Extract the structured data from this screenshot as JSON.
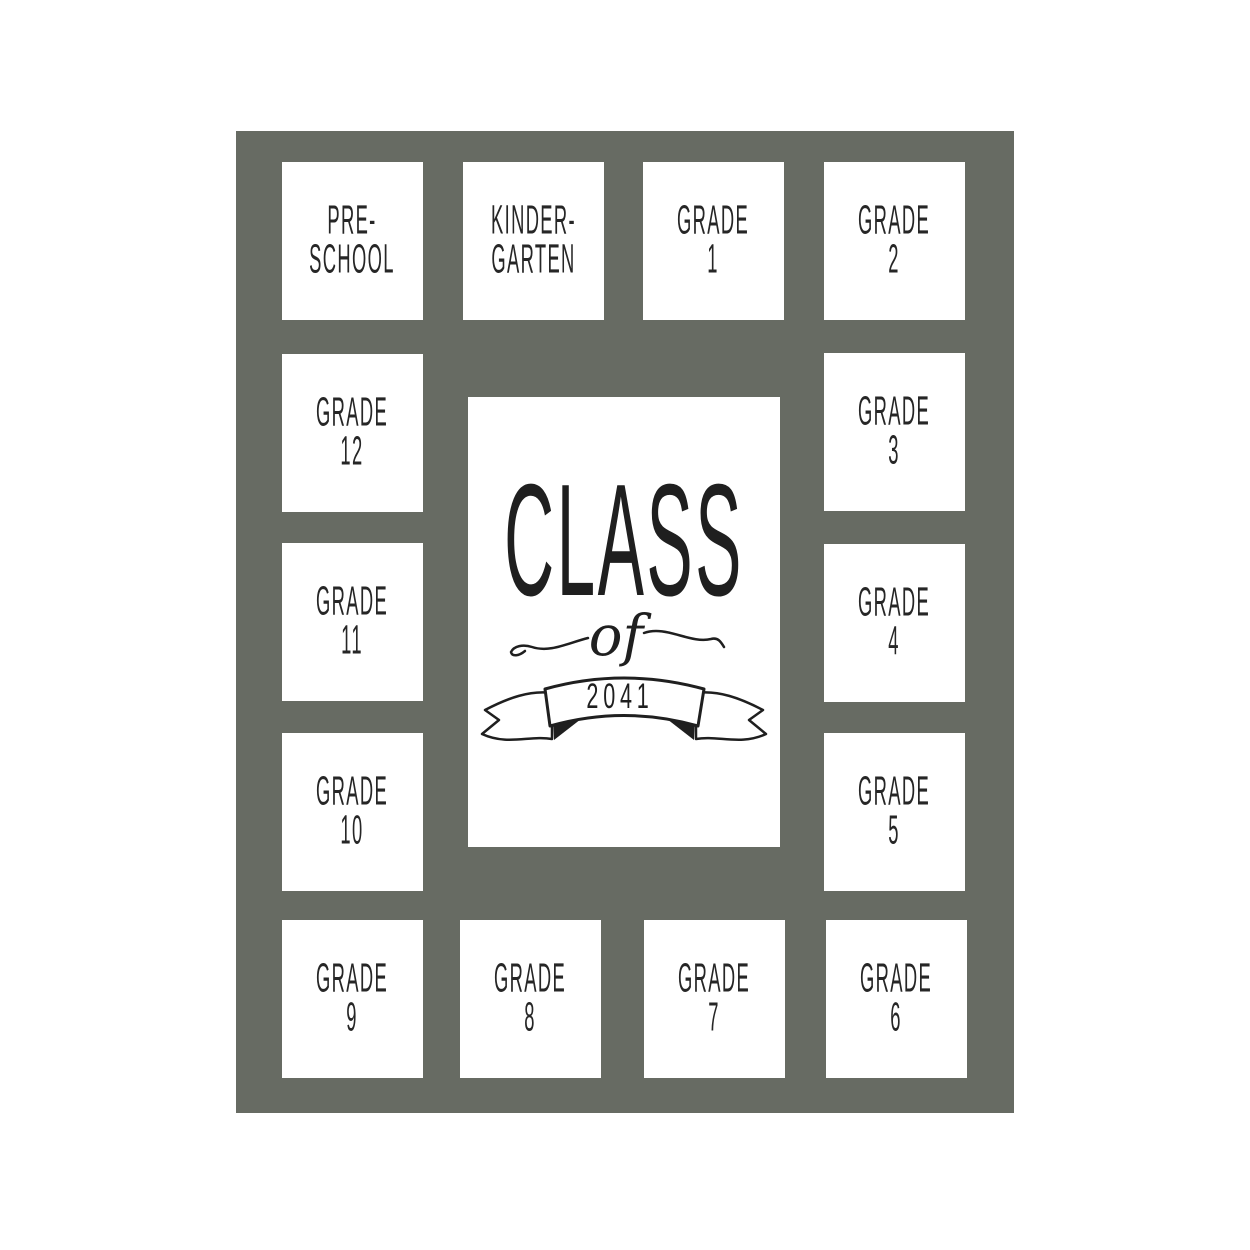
{
  "page": {
    "background_color": "#ffffff"
  },
  "mat": {
    "color": "#676b63",
    "ink_color": "#262626",
    "opening_color": "#ffffff"
  },
  "openings": [
    {
      "id": "preschool",
      "line1": "PRE-",
      "line2": "SCHOOL"
    },
    {
      "id": "kindergarten",
      "line1": "KINDER-",
      "line2": "GARTEN"
    },
    {
      "id": "grade-1",
      "line1": "GRADE",
      "line2": "1"
    },
    {
      "id": "grade-2",
      "line1": "GRADE",
      "line2": "2"
    },
    {
      "id": "grade-3",
      "line1": "GRADE",
      "line2": "3"
    },
    {
      "id": "grade-4",
      "line1": "GRADE",
      "line2": "4"
    },
    {
      "id": "grade-5",
      "line1": "GRADE",
      "line2": "5"
    },
    {
      "id": "grade-6",
      "line1": "GRADE",
      "line2": "6"
    },
    {
      "id": "grade-7",
      "line1": "GRADE",
      "line2": "7"
    },
    {
      "id": "grade-8",
      "line1": "GRADE",
      "line2": "8"
    },
    {
      "id": "grade-9",
      "line1": "GRADE",
      "line2": "9"
    },
    {
      "id": "grade-10",
      "line1": "GRADE",
      "line2": "10"
    },
    {
      "id": "grade-11",
      "line1": "GRADE",
      "line2": "11"
    },
    {
      "id": "grade-12",
      "line1": "GRADE",
      "line2": "12"
    }
  ],
  "center": {
    "title": "CLASS",
    "connector": "of",
    "year": "2041"
  }
}
